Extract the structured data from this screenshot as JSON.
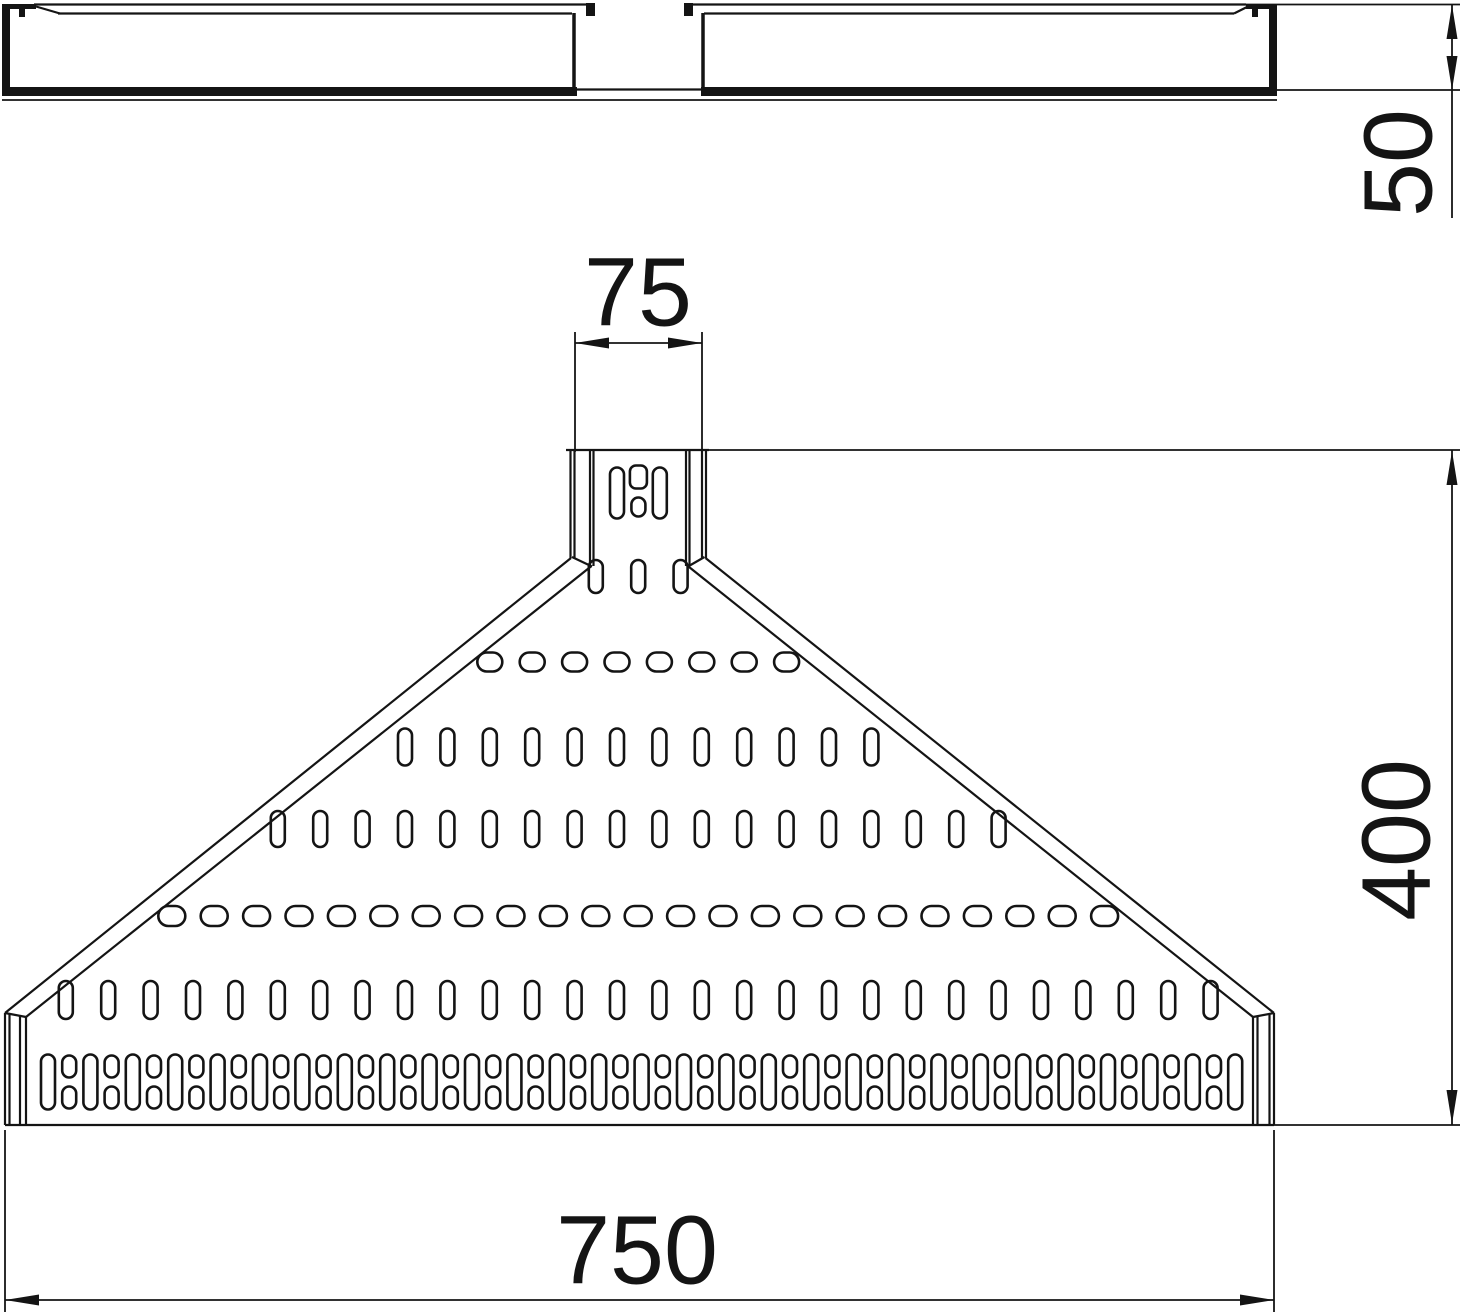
{
  "drawing": {
    "type": "technical-dimension-drawing",
    "views": {
      "side_view": {
        "name": "side elevation"
      },
      "plan_view": {
        "name": "plan view of reducer piece"
      }
    },
    "dimensions": {
      "height": {
        "value": "50"
      },
      "top_width": {
        "value": "75"
      },
      "length": {
        "value": "400"
      },
      "base_width": {
        "value": "750"
      }
    },
    "colors": {
      "line": "#141414",
      "background": "#ffffff"
    }
  }
}
